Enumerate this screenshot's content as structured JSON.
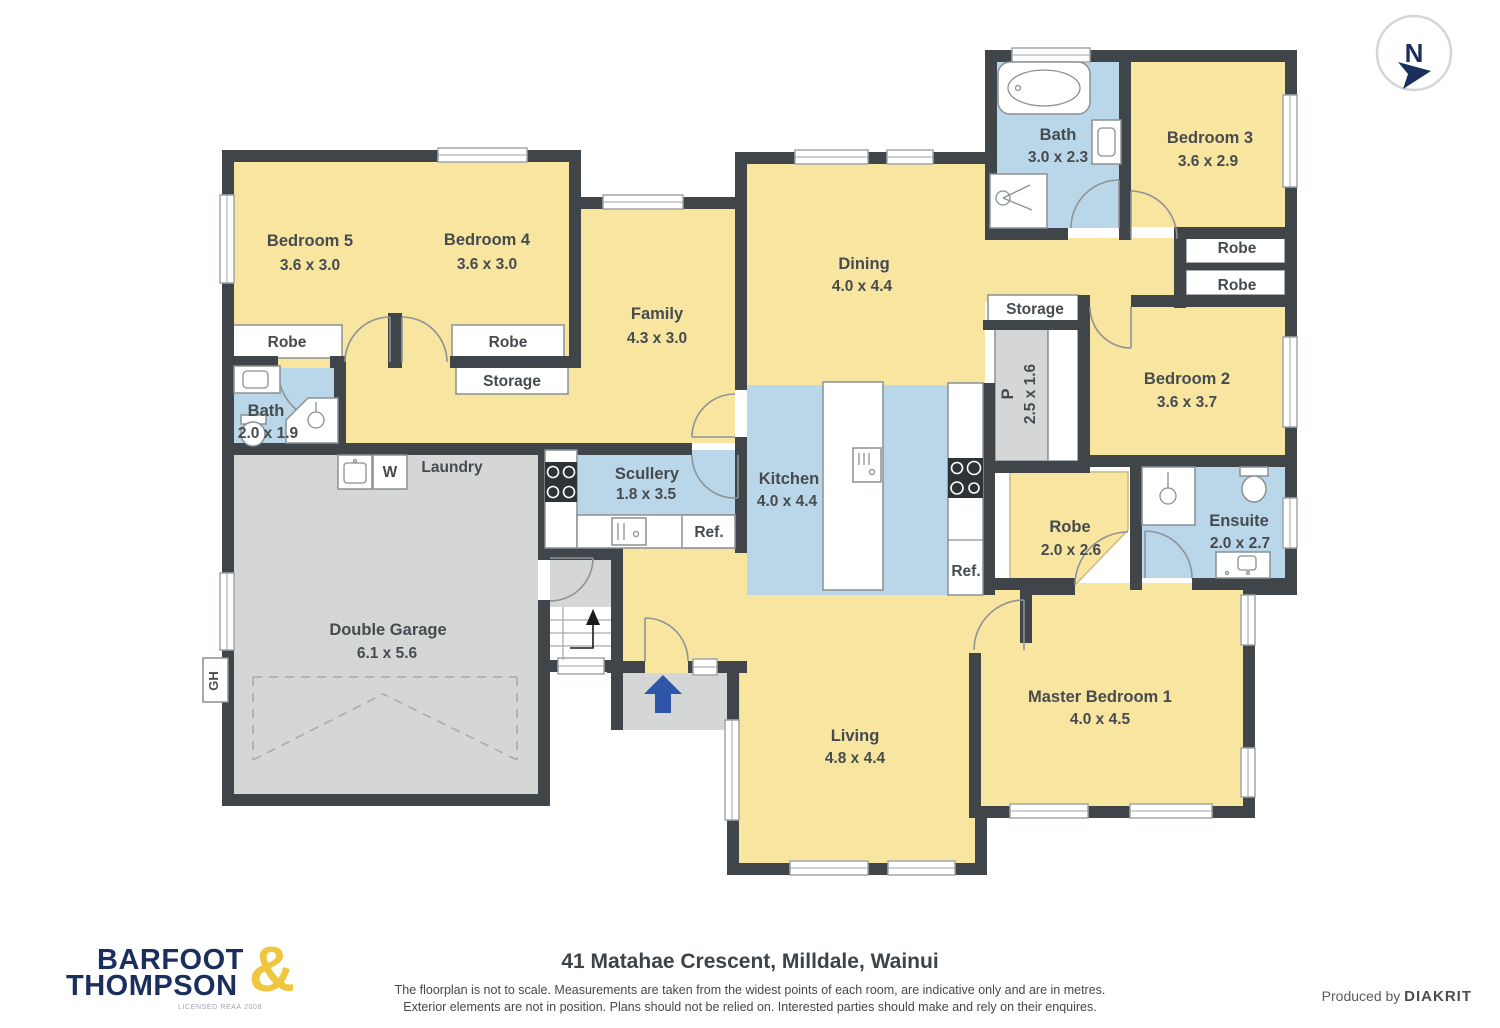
{
  "compass": {
    "label": "N"
  },
  "rooms": {
    "bedroom5": {
      "name": "Bedroom 5",
      "dims": "3.6 x 3.0"
    },
    "bedroom4": {
      "name": "Bedroom 4",
      "dims": "3.6 x 3.0"
    },
    "robe5": {
      "name": "Robe"
    },
    "robe4": {
      "name": "Robe"
    },
    "storage_bed4": {
      "name": "Storage"
    },
    "bath_left": {
      "name": "Bath",
      "dims": "2.0 x 1.9"
    },
    "family": {
      "name": "Family",
      "dims": "4.3 x 3.0"
    },
    "dining": {
      "name": "Dining",
      "dims": "4.0 x 4.4"
    },
    "bath_top": {
      "name": "Bath",
      "dims": "3.0 x 2.3"
    },
    "bedroom3": {
      "name": "Bedroom 3",
      "dims": "3.6 x 2.9"
    },
    "robe3_upper": {
      "name": "Robe"
    },
    "robe3_lower": {
      "name": "Robe"
    },
    "storage_hall": {
      "name": "Storage"
    },
    "pantry": {
      "name": "P",
      "dims": "2.5 x 1.6"
    },
    "bedroom2": {
      "name": "Bedroom 2",
      "dims": "3.6 x 3.7"
    },
    "scullery": {
      "name": "Scullery",
      "dims": "1.8 x 3.5"
    },
    "kitchen": {
      "name": "Kitchen",
      "dims": "4.0 x 4.4"
    },
    "fridge_scullery": {
      "name": "Ref."
    },
    "fridge_kitchen": {
      "name": "Ref."
    },
    "laundry": {
      "name": "Laundry"
    },
    "washer": {
      "name": "W"
    },
    "garage": {
      "name": "Double Garage",
      "dims": "6.1 x 5.6"
    },
    "gh": {
      "name": "GH"
    },
    "living": {
      "name": "Living",
      "dims": "4.8 x 4.4"
    },
    "master": {
      "name": "Master Bedroom 1",
      "dims": "4.0 x 4.5"
    },
    "robe_master": {
      "name": "Robe",
      "dims": "2.0 x 2.6"
    },
    "ensuite": {
      "name": "Ensuite",
      "dims": "2.0 x 2.7"
    }
  },
  "footer": {
    "address": "41 Matahae Crescent, Milldale, Wainui",
    "disclaimer_line1": "The floorplan is not to scale. Measurements are taken from the widest points of each room, are indicative only and are in metres.",
    "disclaimer_line2": "Exterior elements are not in position. Plans should not be relied on. Interested parties should make and rely on their enquires.",
    "produced_by": "Produced by",
    "producer": "DIAKRIT",
    "brand_line1": "BARFOOT",
    "brand_line2": "THOMPSON",
    "brand_amp": "&",
    "brand_license": "LICENSED REAA 2008"
  },
  "colors": {
    "room_yellow": "#F8E5A0",
    "room_blue": "#BAD7E9",
    "room_gray": "#D5D7D6",
    "wall": "#3F4549",
    "brand_navy": "#1B2F5E",
    "brand_gold": "#F0C63F",
    "entry_arrow_blue": "#2F55A8",
    "label_text": "#464B4F"
  }
}
